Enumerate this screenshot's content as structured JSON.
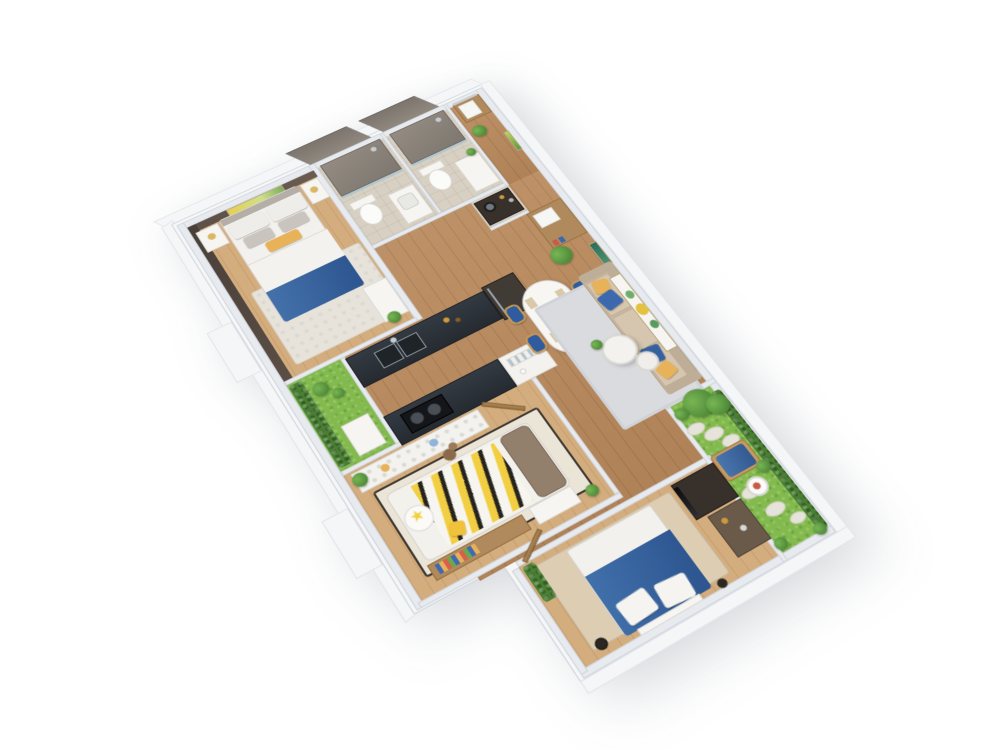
{
  "scene": {
    "type": "3d-floor-plan-render",
    "description": "Isometric 3D render of a three-bedroom apartment floor plan, rotated about 30 degrees, floating on a plain white background",
    "rooms": [
      {
        "name": "master-bedroom",
        "floor": "light wood",
        "contents": [
          "double bed with white duvet and blue throw",
          "yellow lumbar pillow",
          "two white nightstands with gold wire lamps",
          "dark brown accent walls",
          "yellow botanical artwork",
          "white wardrobe with plant",
          "patterned area rug"
        ]
      },
      {
        "name": "master-bathroom",
        "floor": "beige tile",
        "contents": [
          "walk-in shower with tall gray tile walls",
          "white toilet",
          "white vanity sink"
        ]
      },
      {
        "name": "second-bathroom",
        "floor": "beige tile",
        "contents": [
          "walk-in shower with tall gray tile walls",
          "white toilet",
          "vanity with small plant"
        ]
      },
      {
        "name": "laundry-closet",
        "floor": "tile",
        "contents": [
          "black washer unit",
          "storage shelves with bottles"
        ]
      },
      {
        "name": "entry-hall",
        "floor": "wood",
        "contents": [
          "two-tone shoe cabinet",
          "potted plant",
          "small wall art"
        ]
      },
      {
        "name": "kitchen",
        "floor": "wood",
        "contents": [
          "dark countertop with double stainless sink",
          "tall dark fridge cabinet",
          "peninsula counter with black induction cooktop",
          "white cabinet with open dish shelves"
        ]
      },
      {
        "name": "loggia",
        "floor": "artificial grass",
        "contents": [
          "green vertical-garden hedge",
          "white stepping panel",
          "shrubs"
        ]
      },
      {
        "name": "dining-area",
        "floor": "wood",
        "contents": [
          "white oval dining table",
          "four blue chairs with wooden legs",
          "place settings",
          "green centerpiece"
        ]
      },
      {
        "name": "living-room",
        "floor": "wood",
        "contents": [
          "beige three-seat sofa",
          "two blue pillows",
          "two yellow pillows",
          "two round white nesting coffee tables",
          "large botanical artwork with yellow flower",
          "gray rug",
          "tall sideboard with plant",
          "small teal artwork"
        ]
      },
      {
        "name": "kids-bedroom",
        "floor": "light wood",
        "contents": [
          "bed with yellow-black chevron blanket",
          "white star pillow",
          "yellow star cushion",
          "brown headboard cushion",
          "polka-dot wardrobe front",
          "book shelf",
          "white desk",
          "teddy bear",
          "dark-bordered rug",
          "plants"
        ]
      },
      {
        "name": "second-bedroom",
        "floor": "light wood",
        "contents": [
          "double bed with blue duvet and white fold",
          "two white pillows",
          "foot bench",
          "dark TV cabinet with black screen",
          "shelving unit",
          "beige rug",
          "plant shelf",
          "floor speakers"
        ]
      },
      {
        "name": "garden-balcony",
        "floor": "artificial grass",
        "contents": [
          "blue lounge daybed on wood base",
          "white round side table",
          "winding pebble path",
          "large leafy tree",
          "hedges and shrubs",
          "potted plant"
        ]
      }
    ],
    "exterior": [
      "white structural walls with visible thickness",
      "two small white ledges outside the west wall"
    ]
  },
  "palette": {
    "bg": "#ffffff",
    "wall": "#e7eaee",
    "wallEdge": "#d2d6db",
    "wallFace": "#f4f6f8",
    "woodMain": "#b9895c",
    "woodLight": "#d4ad7e",
    "tile": "#d8d0c2",
    "showerTile": "#7f7870",
    "grass": "#82ba4d",
    "hedge": "#4b8034",
    "counterDark": "#333a42",
    "cabinetWood": "#b08a5c",
    "cabinetWhite": "#f3f2ee",
    "sofa": "#c9b7a1",
    "cushion": "#d7c6af",
    "pillowBlue": "#3c68ad",
    "pillowYellow": "#e8b259",
    "bedWhite": "#f3f1ed",
    "bedBlue": "#37649f",
    "accentDark": "#51453d",
    "rugGray": "#d9dbdf",
    "rugBeige": "#dccdb3",
    "rugKids": "#ebe5d7",
    "chairBlue": "#2e5c9e",
    "chairWood": "#c79a58",
    "artYellow": "#e4c23f",
    "plantGreen": "#5d9c3f",
    "plantDark": "#3f7a2e",
    "chevYellow": "#f2cf42",
    "chevDark": "#26231f",
    "glass": "#a9c6d2"
  }
}
